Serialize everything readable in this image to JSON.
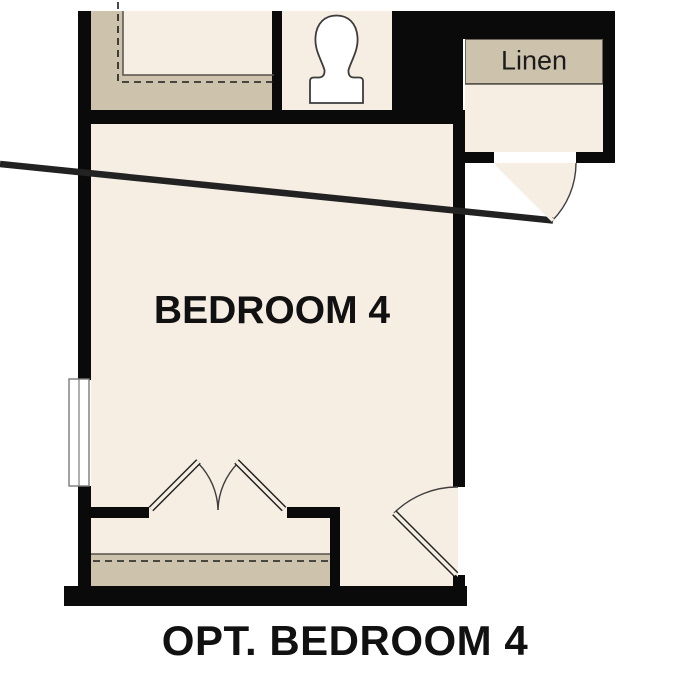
{
  "floorplan": {
    "caption": "OPT. BEDROOM 4",
    "rooms": {
      "bedroom": {
        "label": "BEDROOM 4"
      },
      "linen_closet": {
        "label": "Linen"
      },
      "bathroom": {
        "label": ""
      }
    },
    "fixtures": [
      {
        "name": "toilet-symbol"
      },
      {
        "name": "window-symbol"
      },
      {
        "name": "linen-shelf"
      },
      {
        "name": "closet-shelf-and-rod-top"
      },
      {
        "name": "closet-shelf-and-rod-bottom"
      },
      {
        "name": "double-closet-doors"
      },
      {
        "name": "bedroom-entry-door"
      },
      {
        "name": "linen-closet-door"
      }
    ],
    "colors": {
      "floor": "#f6eee3",
      "shelf": "#cdc2ac",
      "wall": "#0a0a0a",
      "line": "#55504a",
      "dash": "#1c1c1c",
      "fixture": "#ffffff",
      "fixture-stroke": "#3c3c3c",
      "text": "#111111",
      "background": "#ffffff"
    }
  }
}
